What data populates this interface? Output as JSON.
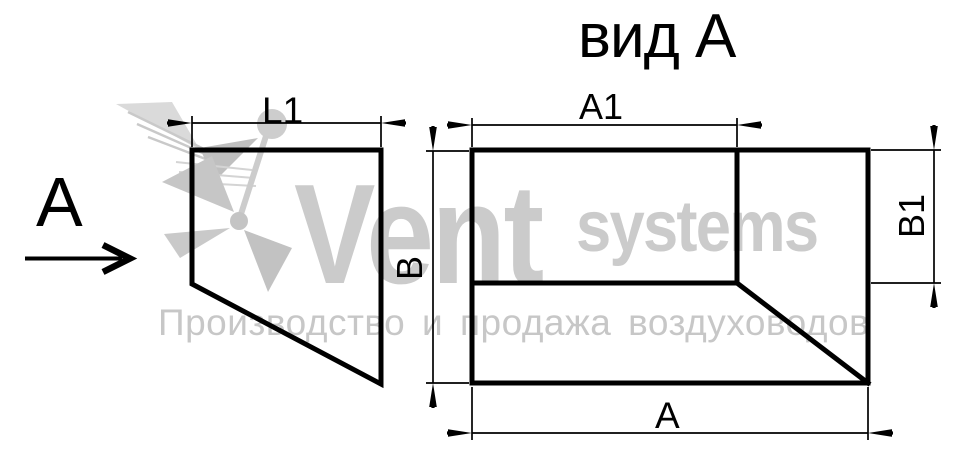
{
  "title": "вид А",
  "direction_view": {
    "letter": "А",
    "arrow": "right-arrow"
  },
  "dimensions": {
    "l1": "L1",
    "a1": "A1",
    "b": "В",
    "b1": "B1",
    "a": "А"
  },
  "watermark": {
    "brand_primary": "Vent",
    "brand_secondary": "systems",
    "tagline": "Производство и продажа воздуховодов",
    "logo": "hummingbird-icon",
    "gray": "#cbcbcb"
  },
  "colors": {
    "line": "#000000",
    "background": "#ffffff",
    "watermark_text": "#c7c7c7"
  }
}
